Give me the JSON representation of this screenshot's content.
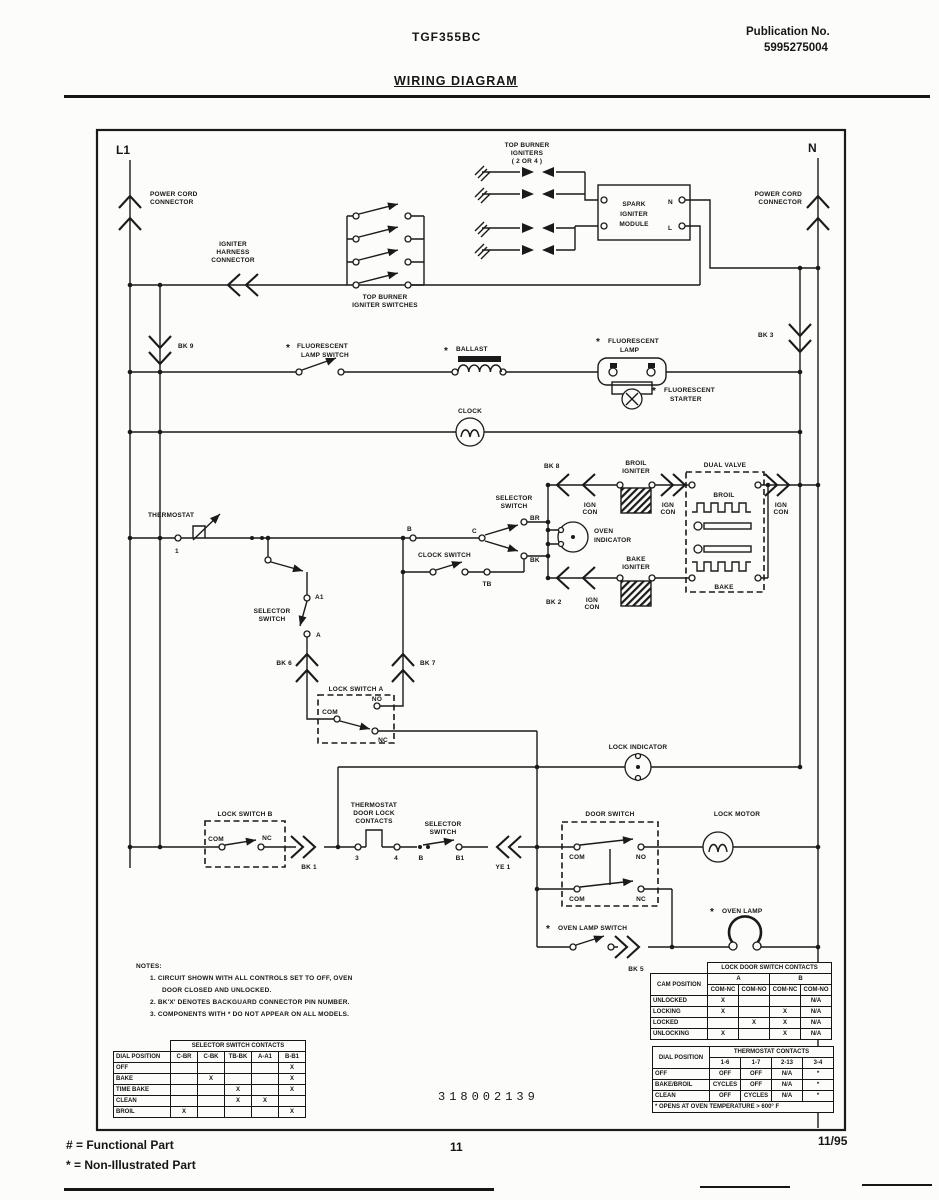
{
  "header": {
    "model": "TGF355BC",
    "publication_label": "Publication No.",
    "publication_number": "5995275004",
    "title": "WIRING DIAGRAM"
  },
  "diagram": {
    "l1": "L1",
    "n": "N",
    "power_cord": "POWER CORD",
    "connector": "CONNECTOR",
    "igniter": "IGNITER",
    "harness": "HARNESS",
    "top_burner": "TOP BURNER",
    "igniter_switches": "IGNITER SWITCHES",
    "igniters": "IGNITERS",
    "igniter_pins": "( 2 OR 4 )",
    "spark": "SPARK",
    "module": "MODULE",
    "n_term": "N",
    "l_term": "L",
    "asterisk": "*",
    "fluorescent": "FLUORESCENT",
    "lamp_switch": "LAMP SWITCH",
    "ballast": "BALLAST",
    "lamp": "LAMP",
    "starter": "STARTER",
    "clock": "CLOCK",
    "thermostat": "THERMOSTAT",
    "selector": "SELECTOR",
    "switch": "SWITCH",
    "clock_switch": "CLOCK SWITCH",
    "oven": "OVEN",
    "indicator": "INDICATOR",
    "broil": "BROIL",
    "bake": "BAKE",
    "ign": "IGN",
    "con": "CON",
    "dual_valve": "DUAL VALVE",
    "lock_switch_a": "LOCK SWITCH A",
    "lock_switch_b": "LOCK SWITCH B",
    "lock_indicator": "LOCK INDICATOR",
    "door_switch": "DOOR SWITCH",
    "lock_motor": "LOCK MOTOR",
    "oven_lamp": "OVEN LAMP",
    "oven_lamp_switch": "OVEN LAMP SWITCH",
    "door_lock": "DOOR LOCK",
    "contacts": "CONTACTS",
    "com": "COM",
    "nc": "NC",
    "no": "NO",
    "t_1": "1",
    "t_3": "3",
    "t_4": "4",
    "t_b": "B",
    "t_b1": "B1",
    "t_a": "A",
    "t_a1": "A1",
    "t_c": "C",
    "t_br": "BR",
    "t_bk": "BK",
    "t_tb": "TB",
    "bk1": "BK 1",
    "bk2": "BK 2",
    "bk3": "BK 3",
    "bk5": "BK 5",
    "bk6": "BK 6",
    "bk7": "BK 7",
    "bk8": "BK 8",
    "bk9": "BK 9",
    "ye1": "YE 1",
    "part_number": "318002139"
  },
  "notes": {
    "title": "NOTES:",
    "line1": "1. CIRCUIT SHOWN WITH ALL CONTROLS SET TO OFF, OVEN",
    "line1b": "DOOR CLOSED AND UNLOCKED.",
    "line2": "2. BK'X' DENOTES BACKGUARD CONNECTOR PIN NUMBER.",
    "line3": "3. COMPONENTS WITH * DO NOT APPEAR ON ALL MODELS."
  },
  "tables": {
    "lock": {
      "title": "LOCK DOOR SWITCH CONTACTS",
      "row_header": "CAM POSITION",
      "group_a": "A",
      "group_b": "B",
      "cols": [
        "COM-NC",
        "COM-NO",
        "COM-NC",
        "COM-NO"
      ],
      "rows": [
        {
          "label": "UNLOCKED",
          "cells": [
            "X",
            "",
            "",
            "N/A"
          ]
        },
        {
          "label": "LOCKING",
          "cells": [
            "X",
            "",
            "X",
            "N/A"
          ]
        },
        {
          "label": "LOCKED",
          "cells": [
            "",
            "X",
            "X",
            "N/A"
          ]
        },
        {
          "label": "UNLOCKING",
          "cells": [
            "X",
            "",
            "X",
            "N/A"
          ]
        }
      ]
    },
    "selector": {
      "title": "SELECTOR SWITCH CONTACTS",
      "row_header": "DIAL POSITION",
      "cols": [
        "C-BR",
        "C-BK",
        "TB-BK",
        "A-A1",
        "B-B1"
      ],
      "rows": [
        {
          "label": "OFF",
          "cells": [
            "",
            "",
            "",
            "",
            "X"
          ]
        },
        {
          "label": "BAKE",
          "cells": [
            "",
            "X",
            "",
            "",
            "X"
          ]
        },
        {
          "label": "TIME BAKE",
          "cells": [
            "",
            "",
            "X",
            "",
            "X"
          ]
        },
        {
          "label": "CLEAN",
          "cells": [
            "",
            "",
            "X",
            "X",
            ""
          ]
        },
        {
          "label": "BROIL",
          "cells": [
            "X",
            "",
            "",
            "",
            "X"
          ]
        }
      ]
    },
    "thermostat": {
      "title": "THERMOSTAT CONTACTS",
      "row_header": "DIAL POSITION",
      "cols": [
        "1-6",
        "1-7",
        "2-13",
        "3-4"
      ],
      "rows": [
        {
          "label": "OFF",
          "cells": [
            "OFF",
            "OFF",
            "N/A",
            "*"
          ]
        },
        {
          "label": "BAKE/BROIL",
          "cells": [
            "CYCLES",
            "OFF",
            "N/A",
            "*"
          ]
        },
        {
          "label": "CLEAN",
          "cells": [
            "OFF",
            "CYCLES",
            "N/A",
            "*"
          ]
        }
      ],
      "note": "* OPENS AT OVEN TEMPERATURE > 600° F"
    }
  },
  "footer": {
    "functional": "# = Functional Part",
    "non_illustrated": "* = Non-Illustrated Part",
    "page": "11",
    "date": "11/95"
  }
}
